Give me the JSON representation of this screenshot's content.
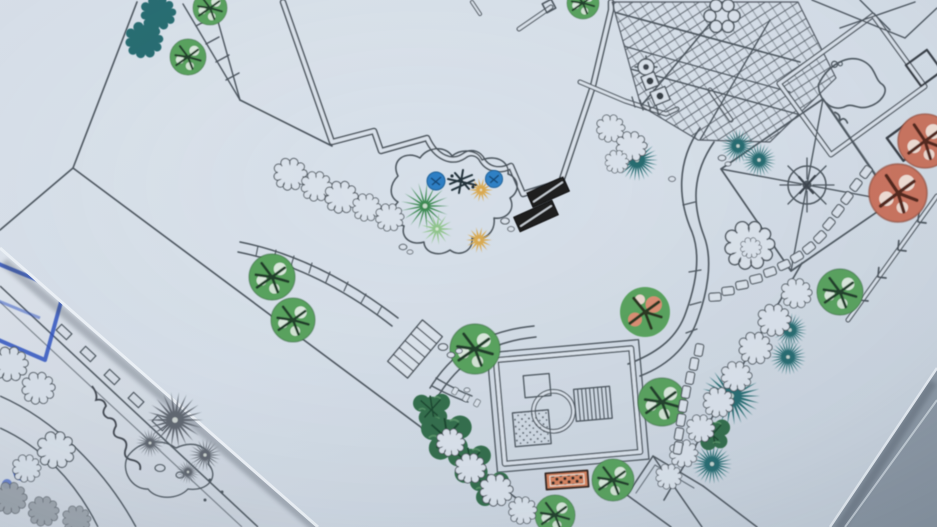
{
  "scene": {
    "description": "Angled photograph of a printed landscape garden site plan with colored plant symbols (house footprint, timber deck, pond panel, compass pavilion, gazebo, curved paths, planting beds), overlapping a second black-and-white plan sketch annotated with blue marker at the bottom-left, lying on a gray-blue table",
    "main_sheet": {
      "content": "colored landscape master plan"
    },
    "under_sheet": {
      "content": "black-and-white concept plan with blue marker sketch"
    }
  },
  "palette": {
    "line": "#49525b",
    "line_soft": "#6b7480",
    "paper": "#d9e1ea",
    "paper_dark": "#c6d0da",
    "paper2": "#dce2ea",
    "table": "#9daab6",
    "table_dark": "#8793a0",
    "teal": "#23696e",
    "tree_green": "#55a05a",
    "tree_green_light": "#8fc48b",
    "foliage_dark": "#2e6b46",
    "gold": "#d9a94f",
    "shrub_blue": "#2f7fc4",
    "orange_tree": "#c9705a",
    "orange_mat": "#d8815b",
    "gray_plant": "#5d646d",
    "marker_blue": "#2b4fc0",
    "bench_black": "#1a1b1d"
  },
  "plan": {
    "features": [
      "site-boundary",
      "lawn",
      "house-footprint",
      "timber-deck-pergola",
      "table-with-chairs",
      "pond-panel",
      "pavilion-with-compass",
      "planter-squares",
      "fence-with-arrows",
      "stepping-stones",
      "planting-bed",
      "benches",
      "walkway-with-steps",
      "broad-curved-path",
      "gazebo",
      "entry-mat",
      "gabled-outbuilding",
      "boundary-shrubs",
      "specimen-trees"
    ],
    "plants": [
      {
        "t": "teal-cloud",
        "x": 160,
        "y": 15,
        "s": 0.75
      },
      {
        "t": "teal-cloud",
        "x": 146,
        "y": 42,
        "s": 0.8
      },
      {
        "t": "green-tree",
        "x": 210,
        "y": 8,
        "s": 0.85
      },
      {
        "t": "green-tree",
        "x": 188,
        "y": 57,
        "s": 0.9
      },
      {
        "t": "green-tree",
        "x": 583,
        "y": 3,
        "s": 0.8
      },
      {
        "t": "green-tree",
        "x": 272,
        "y": 277,
        "s": 1.15
      },
      {
        "t": "green-tree",
        "x": 293,
        "y": 320,
        "s": 1.1
      },
      {
        "t": "green-tree",
        "x": 475,
        "y": 349,
        "s": 1.25
      },
      {
        "t": "green-tree",
        "x": 840,
        "y": 292,
        "s": 1.15
      },
      {
        "t": "green-tree",
        "x": 662,
        "y": 402,
        "s": 1.2
      },
      {
        "t": "green-tree",
        "x": 613,
        "y": 480,
        "s": 1.05
      },
      {
        "t": "green-tree",
        "x": 555,
        "y": 515,
        "s": 1.0
      },
      {
        "t": "mixed-tree",
        "x": 645,
        "y": 312,
        "s": 1.25
      },
      {
        "t": "orange-tree",
        "x": 925,
        "y": 141,
        "s": 1.35
      },
      {
        "t": "orange-tree",
        "x": 898,
        "y": 193,
        "s": 1.45
      },
      {
        "t": "teal-star",
        "x": 637,
        "y": 160,
        "s": 1.05
      },
      {
        "t": "teal-star",
        "x": 738,
        "y": 146,
        "s": 0.85
      },
      {
        "t": "teal-star",
        "x": 759,
        "y": 160,
        "s": 0.85
      },
      {
        "t": "teal-star",
        "x": 790,
        "y": 330,
        "s": 0.85
      },
      {
        "t": "teal-star",
        "x": 788,
        "y": 357,
        "s": 0.9
      },
      {
        "t": "teal-star",
        "x": 731,
        "y": 396,
        "s": 1.45
      },
      {
        "t": "teal-star",
        "x": 712,
        "y": 464,
        "s": 1.0
      },
      {
        "t": "dark-foliage",
        "x": 432,
        "y": 408,
        "s": 0.95
      },
      {
        "t": "dark-foliage",
        "x": 447,
        "y": 435,
        "s": 1.3
      },
      {
        "t": "dark-foliage",
        "x": 470,
        "y": 462,
        "s": 1.1
      },
      {
        "t": "dark-foliage",
        "x": 490,
        "y": 487,
        "s": 1.0
      },
      {
        "t": "dark-foliage",
        "x": 713,
        "y": 433,
        "s": 0.9
      },
      {
        "t": "palm",
        "x": 425,
        "y": 206,
        "s": 1.2
      },
      {
        "t": "light-fan",
        "x": 437,
        "y": 229,
        "s": 0.8
      },
      {
        "t": "gold-star",
        "x": 481,
        "y": 190,
        "s": 0.6
      },
      {
        "t": "gold-star",
        "x": 479,
        "y": 240,
        "s": 0.65
      },
      {
        "t": "blue-shrub",
        "x": 436,
        "y": 181,
        "s": 1.0
      },
      {
        "t": "blue-shrub",
        "x": 494,
        "y": 179,
        "s": 0.95
      },
      {
        "t": "bed-scribble",
        "x": 462,
        "y": 182,
        "s": 1.0
      },
      {
        "t": "cloud-shrub",
        "x": 292,
        "y": 176,
        "s": 0.7
      },
      {
        "t": "cloud-shrub",
        "x": 318,
        "y": 188,
        "s": 0.65
      },
      {
        "t": "cloud-shrub",
        "x": 343,
        "y": 199,
        "s": 0.7
      },
      {
        "t": "cloud-shrub",
        "x": 368,
        "y": 209,
        "s": 0.6
      },
      {
        "t": "cloud-shrub",
        "x": 391,
        "y": 219,
        "s": 0.6
      },
      {
        "t": "cloud-shrub",
        "x": 752,
        "y": 248,
        "s": 1.05
      },
      {
        "t": "cloud-shrub",
        "x": 752,
        "y": 249,
        "s": 0.45
      },
      {
        "t": "cloud-shrub",
        "x": 798,
        "y": 295,
        "s": 0.65
      },
      {
        "t": "cloud-shrub",
        "x": 776,
        "y": 322,
        "s": 0.7
      },
      {
        "t": "cloud-shrub",
        "x": 757,
        "y": 350,
        "s": 0.7
      },
      {
        "t": "cloud-shrub",
        "x": 738,
        "y": 378,
        "s": 0.65
      },
      {
        "t": "cloud-shrub",
        "x": 720,
        "y": 404,
        "s": 0.65
      },
      {
        "t": "cloud-shrub",
        "x": 702,
        "y": 430,
        "s": 0.6
      },
      {
        "t": "cloud-shrub",
        "x": 685,
        "y": 455,
        "s": 0.6
      },
      {
        "t": "cloud-shrub",
        "x": 670,
        "y": 478,
        "s": 0.55
      },
      {
        "t": "cloud-shrub",
        "x": 452,
        "y": 444,
        "s": 0.6
      },
      {
        "t": "cloud-shrub",
        "x": 472,
        "y": 470,
        "s": 0.65
      },
      {
        "t": "cloud-shrub",
        "x": 498,
        "y": 492,
        "s": 0.7
      },
      {
        "t": "cloud-shrub",
        "x": 524,
        "y": 512,
        "s": 0.6
      },
      {
        "t": "cloud-shrub",
        "x": 612,
        "y": 130,
        "s": 0.6
      },
      {
        "t": "cloud-shrub",
        "x": 633,
        "y": 148,
        "s": 0.65
      },
      {
        "t": "cloud-shrub",
        "x": 618,
        "y": 163,
        "s": 0.5
      },
      {
        "t": "rock",
        "x": 505,
        "y": 221,
        "s": 1
      },
      {
        "t": "rock",
        "x": 511,
        "y": 229,
        "s": 0.8
      },
      {
        "t": "rock",
        "x": 403,
        "y": 247,
        "s": 0.9
      },
      {
        "t": "rock",
        "x": 410,
        "y": 252,
        "s": 0.7
      },
      {
        "t": "rock",
        "x": 722,
        "y": 158,
        "s": 0.9
      },
      {
        "t": "rock",
        "x": 728,
        "y": 164,
        "s": 0.7
      },
      {
        "t": "rock",
        "x": 672,
        "y": 179,
        "s": 0.8
      },
      {
        "t": "rock",
        "x": 443,
        "y": 347,
        "s": 1.1
      },
      {
        "t": "rock",
        "x": 451,
        "y": 355,
        "s": 0.9
      },
      {
        "t": "rock",
        "x": 459,
        "y": 351,
        "s": 0.8
      },
      {
        "t": "rock",
        "x": 467,
        "y": 390,
        "s": 0.7
      },
      {
        "t": "cloud-shrub",
        "x": 12,
        "y": 366,
        "s": 0.75
      },
      {
        "t": "cloud-shrub",
        "x": 40,
        "y": 390,
        "s": 0.7
      },
      {
        "t": "cloud-shrub",
        "x": 58,
        "y": 452,
        "s": 0.8
      },
      {
        "t": "cloud-shrub",
        "x": 28,
        "y": 470,
        "s": 0.6
      },
      {
        "t": "gray-cloud",
        "x": 12,
        "y": 500,
        "s": 0.7
      },
      {
        "t": "gray-cloud",
        "x": 45,
        "y": 513,
        "s": 0.65
      },
      {
        "t": "gray-cloud",
        "x": 78,
        "y": 521,
        "s": 0.6
      },
      {
        "t": "gray-star",
        "x": 175,
        "y": 420,
        "s": 1.4
      },
      {
        "t": "gray-star",
        "x": 205,
        "y": 455,
        "s": 0.8
      },
      {
        "t": "gray-star",
        "x": 150,
        "y": 443,
        "s": 0.7
      },
      {
        "t": "gray-star",
        "x": 188,
        "y": 472,
        "s": 0.6
      }
    ],
    "stepping_stones": [
      {
        "x": 866,
        "y": 172,
        "r": -53
      },
      {
        "x": 856,
        "y": 185,
        "r": -53
      },
      {
        "x": 847,
        "y": 198,
        "r": -53
      },
      {
        "x": 838,
        "y": 211,
        "r": -53
      },
      {
        "x": 829,
        "y": 224,
        "r": -50
      },
      {
        "x": 820,
        "y": 237,
        "r": -45
      },
      {
        "x": 809,
        "y": 248,
        "r": -38
      },
      {
        "x": 797,
        "y": 257,
        "r": -30
      },
      {
        "x": 784,
        "y": 265,
        "r": -24
      },
      {
        "x": 770,
        "y": 272,
        "r": -18
      },
      {
        "x": 756,
        "y": 279,
        "r": -14
      },
      {
        "x": 742,
        "y": 285,
        "r": -10
      },
      {
        "x": 728,
        "y": 291,
        "r": -6
      },
      {
        "x": 715,
        "y": 297,
        "r": -3
      },
      {
        "x": 699,
        "y": 350,
        "r": -80
      },
      {
        "x": 694,
        "y": 364,
        "r": -80
      },
      {
        "x": 690,
        "y": 378,
        "r": -80
      },
      {
        "x": 686,
        "y": 392,
        "r": -80
      },
      {
        "x": 683,
        "y": 406,
        "r": -80
      },
      {
        "x": 681,
        "y": 420,
        "r": -80
      },
      {
        "x": 679,
        "y": 434,
        "r": -80
      },
      {
        "x": 678,
        "y": 448,
        "r": -80
      },
      {
        "x": 455,
        "y": 391,
        "r": -60,
        "s": 0.6
      },
      {
        "x": 466,
        "y": 398,
        "r": -60,
        "s": 0.6
      },
      {
        "x": 477,
        "y": 403,
        "r": -60,
        "s": 0.6
      }
    ]
  }
}
